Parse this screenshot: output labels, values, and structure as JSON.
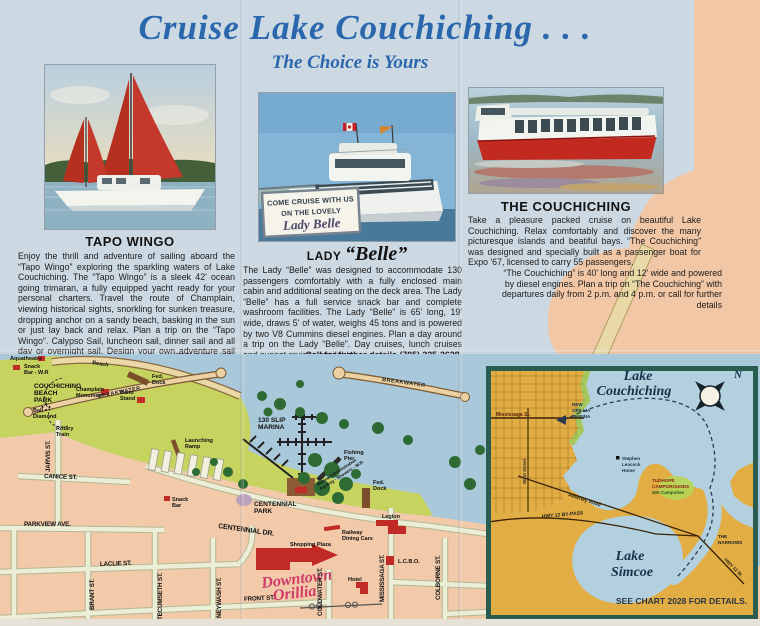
{
  "header": {
    "title": "Cruise Lake Couchiching . . .",
    "subtitle": "The Choice is Yours"
  },
  "sections": [
    {
      "caption": "TAPO WINGO",
      "body": "Enjoy the thrill and adventure of sailing aboard the “Tapo Wingo” exploring the sparkling waters of Lake Couchiching. The “Tapo Wingo” is a sleek 42' ocean going trimaran, a fully equipped yacht ready for your personal charters. Travel the route of Champlain, viewing historical sights, snorkling for sunken treasure, dropping anchor on a sandy beach, basking in the sun or just lay back and relax. Plan a trip on the “Tapo Wingo”. Calypso Sail, luncheon sail, dinner sail and all day or overnight sail. Design your own adventure sail and for further details call",
      "phone": "(705) 325-8100."
    },
    {
      "caption_prefix": "LADY",
      "caption_name": "“Belle”",
      "photo_sign": [
        "COME CRUISE WITH US",
        "ON THE LOVELY",
        "Lady Belle"
      ],
      "body": "The Lady “Belle” was designed to accommodate 130 passengers comfortably with a fully enclosed main cabin and additional seating on the deck area. The Lady “Belle” has a full service snack bar and complete washroom facilities. The Lady “Belle” is 65' long, 19' wide, draws 5' of water, weighs 45 tons and is powered by two V8 Cummins diesel engines. Plan a day around a trip on the Lady “Belle”. Day cruises, lunch cruises and sunset cruises available.",
      "phone": "Call for further details (705) 325-2628."
    },
    {
      "caption": "THE COUCHICHING",
      "body_intro": "Take a pleasure packed cruise on beautiful Lake Couchiching. Relax comfortably and discover the many picturesque islands and beatiful bays. “The Couchiching” was designed and specially built as a passenger boat for Expo '67, licensed to carry 55 passengers.",
      "body_wrap": "“The Couchiching” is 40' long and 12' wide and powered by diesel engines. Plan a trip on “The Couchiching” with departures daily from 2 p.m. and 4 p.m. or call for further details",
      "phone": "(705) 326-7749."
    }
  ],
  "map": {
    "labels": {
      "aquatheatre": "Aquatheatre",
      "snack_bar_wr": [
        "Snack",
        "Bar - W.R"
      ],
      "beach": "Beach",
      "couchiching_beach_park": [
        "COUCHICHING",
        "BEACH",
        "PARK"
      ],
      "champlain_monument": [
        "Champlain",
        "Monument"
      ],
      "band_stand": [
        "Band",
        "Stand"
      ],
      "ball_diamond": [
        "Ball",
        "Diamond"
      ],
      "rotary_train": [
        "Rotary",
        "Train"
      ],
      "fed_dock_north": [
        "Fed.",
        "Dock"
      ],
      "breakwater_west": "BREAKWATER",
      "breakwater_east": "BREAKWATER",
      "launching_ramp": [
        "Launching",
        "Ramp"
      ],
      "slip_marina": [
        "130 SLIP",
        "MARINA"
      ],
      "fishing_pier": [
        "Fishing",
        "Pier"
      ],
      "marina_admin": [
        "Marina Administration",
        "Parking - Showers - W.R."
      ],
      "fed_dock_south": [
        "Fed.",
        "Dock"
      ],
      "centennial_park": [
        "CENTENNIAL",
        "PARK"
      ],
      "snack_bar_south": [
        "Snack",
        "Bar"
      ],
      "legion": "Legion",
      "railway_dining_cars": [
        "Railway",
        "Dining Cars"
      ],
      "shopping_plaza": "Shopping Plaza",
      "lcbo": "L.C.B.O.",
      "hotel": "Hotel",
      "downtown_orillia": [
        "Downtown",
        "Orillia"
      ],
      "streets": {
        "jarvis": "JARVIS ST.",
        "canice": "CANICE ST.",
        "parkview": "PARKVIEW AVE.",
        "laclie": "LACLIE ST.",
        "brant": "BRANT ST.",
        "tecumseth": "TECUMSETH ST.",
        "neywash": "NEYWASH ST.",
        "front": "FRONT ST.",
        "coldwater": "COLDWATER ST.",
        "mississaga": "MISSISSAGA ST.",
        "colborne": "COLBORNE ST.",
        "centennial_dr": "CENTENNIAL DR."
      }
    }
  },
  "inset": {
    "title": [
      "Lake",
      "Couchiching"
    ],
    "compass_n": "N",
    "labels": {
      "mississaga": "Mississaga St.",
      "new_orillia_marina": [
        "NEW",
        "ORILLIA",
        "MARINA"
      ],
      "west_street": "West Street",
      "atherley_road": "Atherley Road",
      "stephen_leacock": [
        "Stephen",
        "Leacock",
        "Home"
      ],
      "tudhope": [
        "TUDHOPE",
        "CAMPGROUNDS",
        "400 Campsites"
      ],
      "hwy12_bypass": "HWY 12 BY-PASS",
      "the_narrows": [
        "THE",
        "NARROWS"
      ],
      "hwy12w": "HWY 12 W.",
      "lake_simcoe": [
        "Lake",
        "Simcoe"
      ],
      "see_chart": "SEE CHART 2028 FOR DETAILS."
    }
  },
  "colors": {
    "accent_blue": "#2b67ad",
    "panel_blue": "#cdd9e2",
    "peach": "#f2c7a6",
    "map_water": "#a9c8da",
    "map_park": "#c6d45f",
    "inset_land": "#e2ad42",
    "inset_border": "#2a5c50",
    "landmark_red": "#c22a26",
    "script_pink": "#cf3a68"
  }
}
